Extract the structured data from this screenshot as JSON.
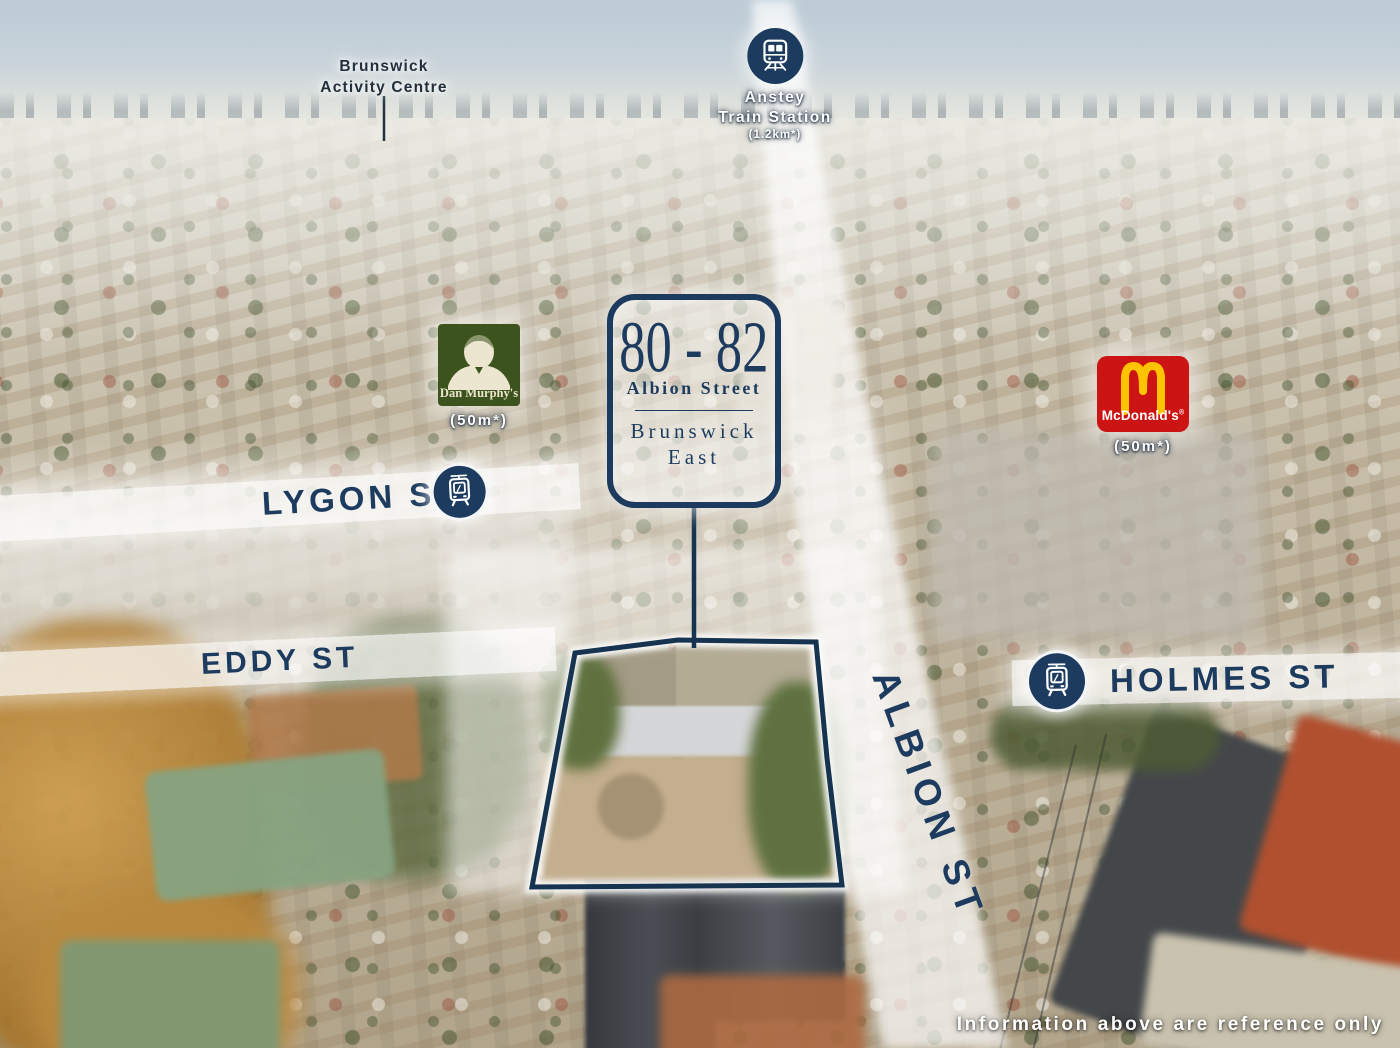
{
  "scene": {
    "disclaimer": "Information above are reference only"
  },
  "property_badge": {
    "number": "80 - 82",
    "street": "Albion Street",
    "suburb_line1": "Brunswick",
    "suburb_line2": "East"
  },
  "landmarks": {
    "activity_centre": {
      "line1": "Brunswick",
      "line2": "Activity Centre"
    },
    "train_station": {
      "line1": "Anstey",
      "line2": "Train Station",
      "distance": "(1.2km*)"
    },
    "dan_murphys": {
      "brand": "Dan Murphy's",
      "distance": "(50m*)"
    },
    "mcdonalds": {
      "brand": "McDonald's",
      "registered": "®",
      "distance": "(50m*)"
    }
  },
  "streets": {
    "lygon": "LYGON ST",
    "eddy": "EDDY ST",
    "holmes": "HOLMES ST",
    "albion": "ALBION ST"
  },
  "colors": {
    "navy": "#1d3b5e",
    "mcdonalds_red": "#cc1414",
    "mcdonalds_yellow": "#ffc300",
    "dan_murphys_green": "#3d531d"
  }
}
